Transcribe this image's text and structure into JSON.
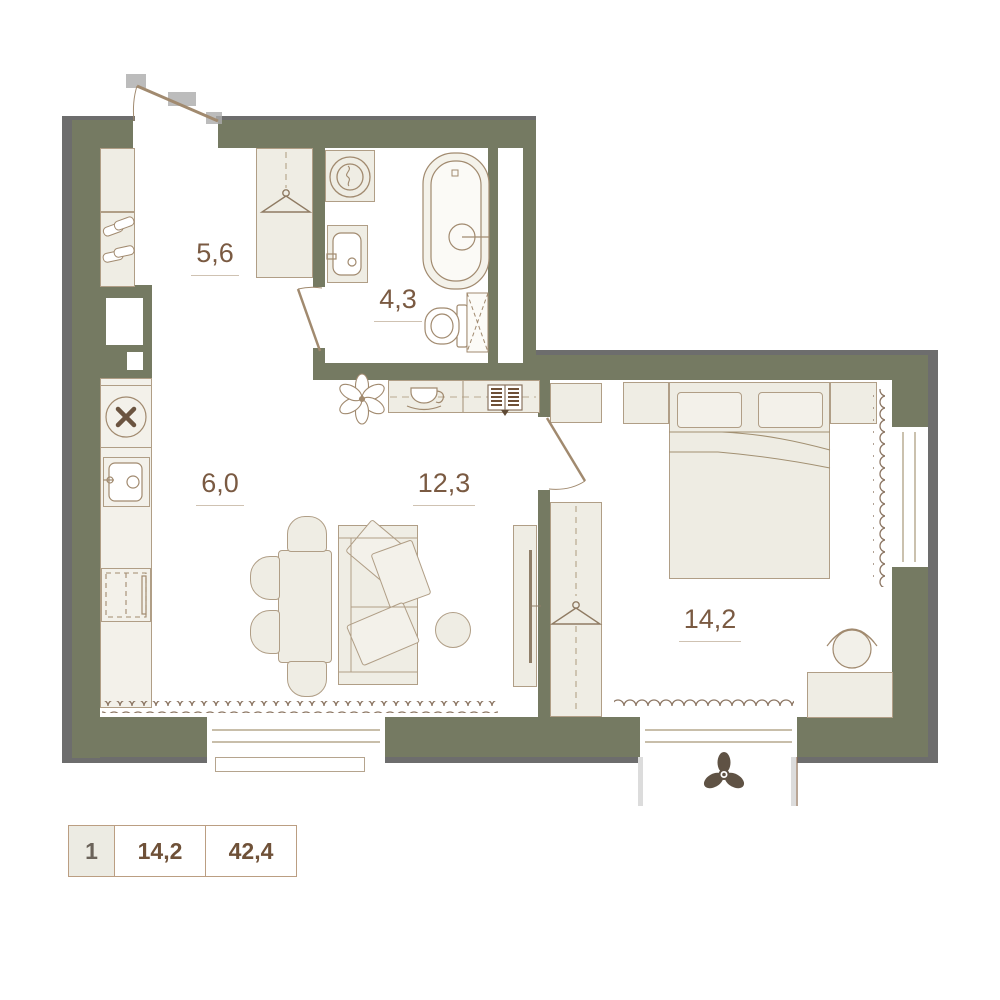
{
  "rooms": [
    {
      "name": "hallway",
      "area": "5,6"
    },
    {
      "name": "bathroom",
      "area": "4,3"
    },
    {
      "name": "kitchen",
      "area": "6,0"
    },
    {
      "name": "living-room",
      "area": "12,3"
    },
    {
      "name": "bedroom",
      "area": "14,2"
    }
  ],
  "legend": {
    "rooms_count": "1",
    "living_area": "14,2",
    "total_area": "42,4"
  },
  "icons": [
    "entry-door",
    "bathroom-door",
    "bedroom-door",
    "wardrobe-hanger",
    "shoe-rack",
    "washing-machine",
    "bathroom-sink",
    "bathtub",
    "toilet",
    "duct-hatch",
    "stove",
    "kitchen-sink",
    "fridge",
    "bar-shelf",
    "plant",
    "coffee-cup",
    "open-book",
    "dining-table",
    "chair",
    "sofa",
    "pillow",
    "pouf",
    "tv-console",
    "bed",
    "nightstand",
    "desk",
    "desk-chair",
    "curtain-wave",
    "radiator-wave",
    "window",
    "balcony",
    "fan"
  ],
  "colors": {
    "wall": "#757a62",
    "outer_edge": "#6d6d6d",
    "furniture_fill": "#efede4",
    "outline": "#a18a6f",
    "label_text": "#7a5a42",
    "legend_value_text": "#6f5138",
    "legend_index_text": "#6b635a",
    "fan": "#5f5244",
    "background": "#ffffff"
  }
}
